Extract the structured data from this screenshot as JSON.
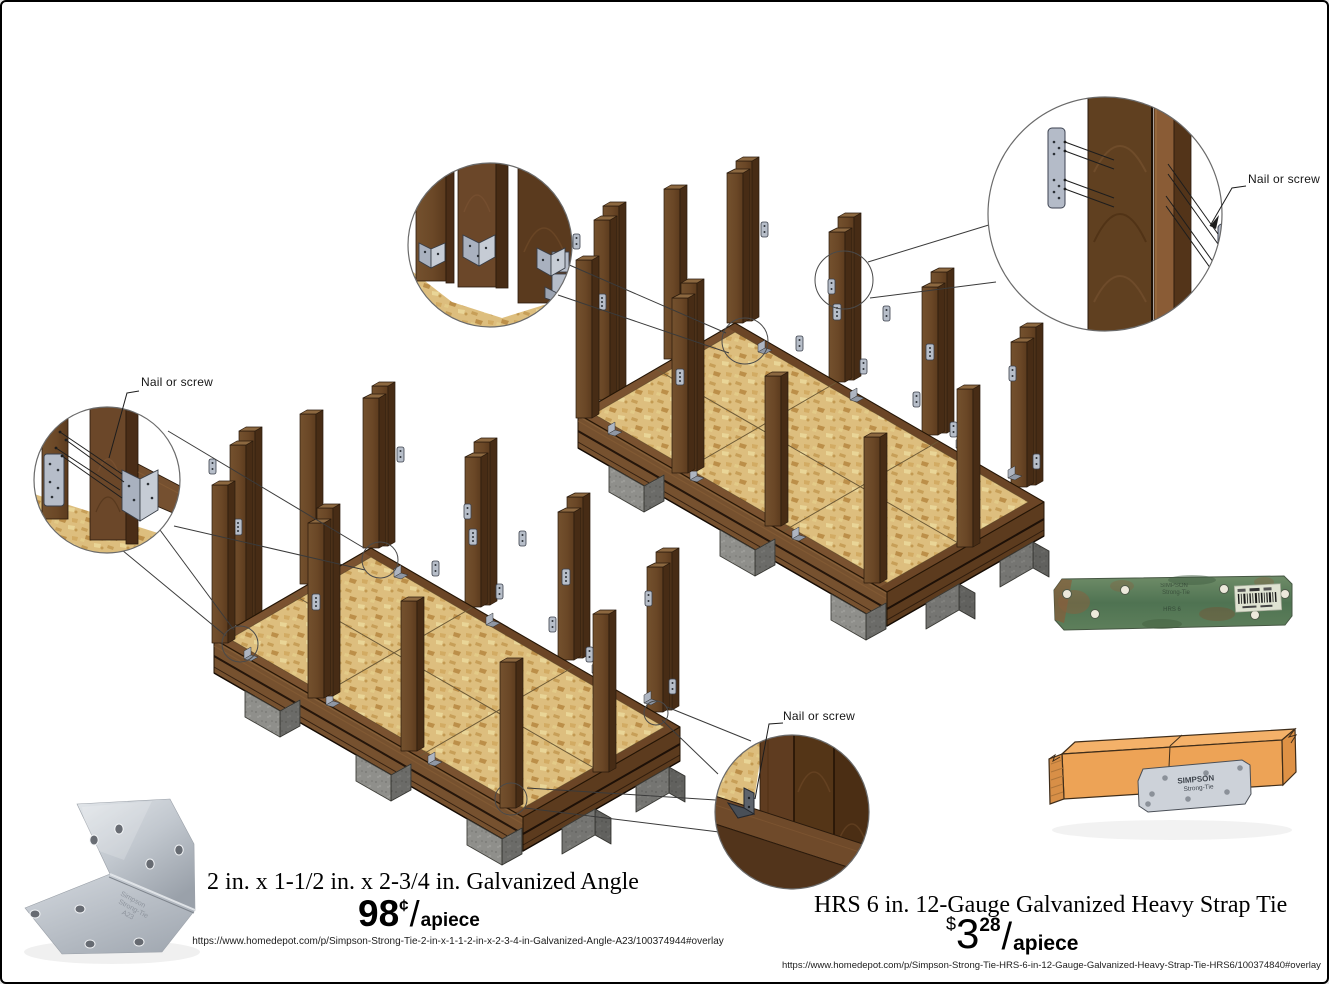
{
  "products": {
    "angle": {
      "title": "2 in. x 1-1/2 in. x 2-3/4 in. Galvanized Angle",
      "price": {
        "amount": "98",
        "symbol": "¢",
        "slash": "/",
        "unit": "apiece"
      },
      "url": "https://www.homedepot.com/p/Simpson-Strong-Tie-2-in-x-1-1-2-in-x-2-3-4-in-Galvanized-Angle-A23/100374944#overlay",
      "stamp": [
        "Simpson",
        "Strong-Tie",
        "A23"
      ]
    },
    "strap": {
      "title": "HRS 6 in. 12-Gauge Galvanized Heavy Strap Tie",
      "price": {
        "currency": "$",
        "dollars": "3",
        "cents": "28",
        "slash": "/",
        "unit": "apiece"
      },
      "url": "https://www.homedepot.com/p/Simpson-Strong-Tie-HRS-6-in-12-Gauge-Galvanized-Heavy-Strap-Tie-HRS6/100374840#overlay",
      "stamp": [
        "SIMPSON",
        "Strong-Tie"
      ],
      "model": "HRS 6"
    }
  },
  "labels": {
    "nail": "Nail or screw"
  },
  "colors": {
    "wood_front": "#6E4B2A",
    "wood_side": "#472C15",
    "wood_top": "#8C6840",
    "rim_front": "#76512F",
    "rim_right": "#5C3B1E",
    "osb": "#DDBE7E",
    "concrete": "#8F8F8B",
    "metal_plate": "#B7BEC9",
    "strap_green": "#4F7352",
    "board_orange": "#EDA356"
  }
}
